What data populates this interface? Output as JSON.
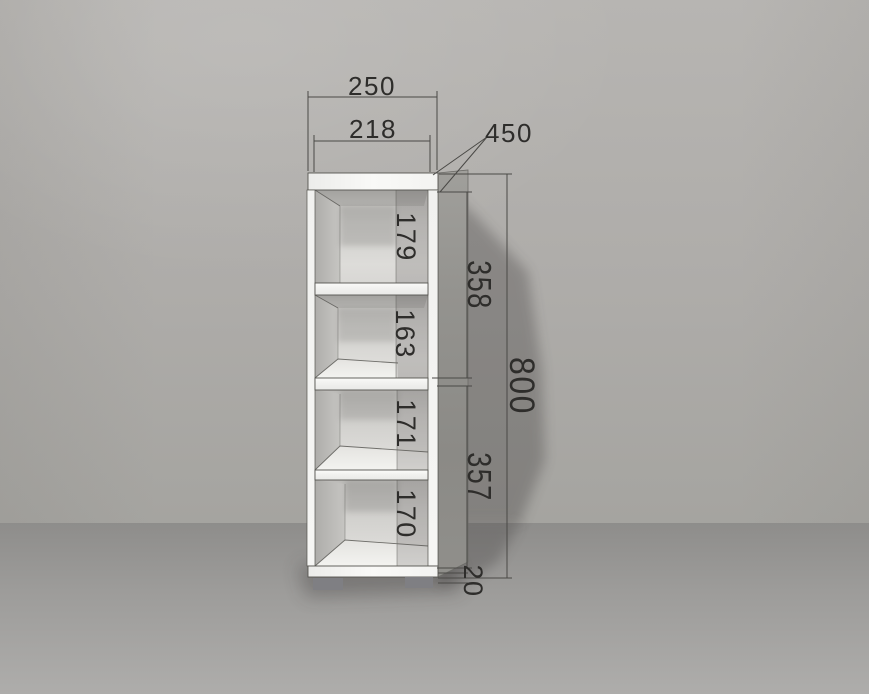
{
  "dimensions": {
    "overall_width": "250",
    "opening_width": "218",
    "depth": "450",
    "overall_height": "800",
    "upper_section_height": "358",
    "lower_section_height": "357",
    "compartment_1_height": "179",
    "compartment_2_height": "163",
    "compartment_3_height": "171",
    "compartment_4_height": "170",
    "plinth_height": "20"
  },
  "colors": {
    "wall": "#b2b0ad",
    "floor": "#9b9a98",
    "cabinet_front": "#f4f4f2",
    "cabinet_side": "#908f8b",
    "interior_back": "#d6d5d2",
    "feet": "#7f7f83",
    "dimension_line": "#4a4946",
    "dimension_text": "#2e2d2b",
    "shadow": "#8c8b88"
  }
}
